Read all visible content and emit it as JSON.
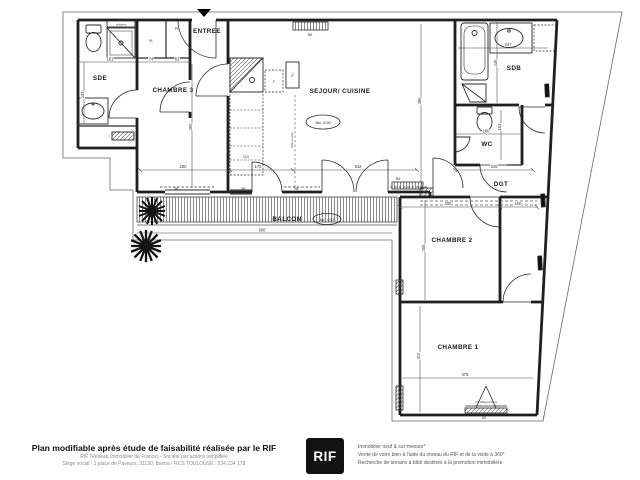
{
  "plan": {
    "rooms": {
      "sde": "SDE",
      "chambre3": "CHAMBRE 3",
      "entree": "ENTREE",
      "sejour": "SEJOUR/ CUISINE",
      "sdb": "SDB",
      "wc": "WC",
      "dgt": "DGT",
      "chambre2": "CHAMBRE 2",
      "chambre1": "CHAMBRE 1",
      "balcon": "BALCON"
    },
    "levels": {
      "sejour": "Niv. 0.00",
      "balcon": "Niv. -0.02"
    },
    "labels": {
      "pl1": "PL",
      "pl2": "PL",
      "paillasse": "paillasse",
      "cui": "CUI",
      "frigo": "F",
      "tel": "TEL",
      "ra1": "RA",
      "ra2": "RA",
      "limite_cuisine": "limite cuisine",
      "win_ch3": "VH",
      "win_k1": "VB",
      "win_k2": "VB",
      "ch1_window": "VH. Allège=120cm",
      "ch1_av": "AV"
    },
    "dims": {
      "sde_w": "161",
      "pl1_w": "74",
      "pl2_w": "63",
      "ch3_w": "250",
      "kitchen_w": "170",
      "sejour_w": "542",
      "dgt_w": "226",
      "sde_h": "233",
      "ch3_h": "360",
      "sejour_h": "495",
      "sdb_w": "247",
      "sdb_h": "236",
      "wc_w": "180",
      "wc_h": "153",
      "ch2_w": "300",
      "corridor_w": "100",
      "ch2_h": "305",
      "ch1_w": "375",
      "ch1_h": "312",
      "balcon_w": "600"
    }
  },
  "footer": {
    "title": "Plan modifiable après étude de faisabilité réalisée par le RIF",
    "company_line": "RIF (Réseau Immobilier de France) - Société par actions simplifiée",
    "address_line": "Siège social : 1 place de Paveurs, 31130, Balma - RCS TOULOUSE : 534 234 178",
    "logo": "RIF",
    "services": [
      "Immobilier neuf & sur-mesure*",
      "Vente de votre bien à l'aide du réseau du RIF et de la visite à 360°",
      "Recherche de terrains à bâtir destinés à la promotion immobilière"
    ]
  }
}
